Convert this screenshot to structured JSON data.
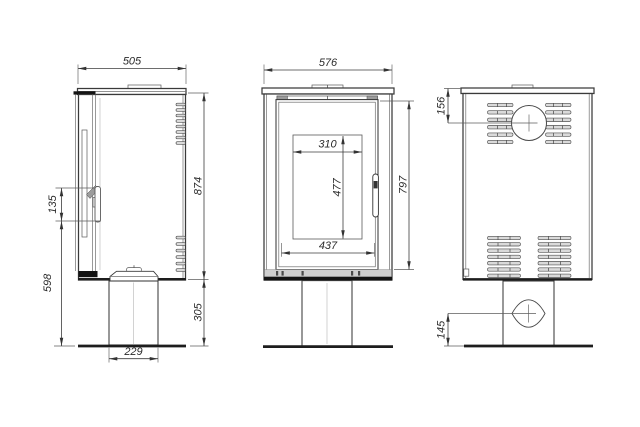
{
  "colors": {
    "background": "#ffffff",
    "outline": "#3a3a3a",
    "thick_line": "#1d1d1d",
    "dimension_line": "#3c3c3c",
    "dimension_text": "#2b2b2b",
    "vent_fill": "#dadada"
  },
  "views": {
    "side": {
      "dims": {
        "depth": "505",
        "body_height": "874",
        "pedestal_height": "305",
        "handle_bottom_to_floor": "598",
        "handle_length": "135",
        "pedestal_depth": "229"
      }
    },
    "front": {
      "dims": {
        "width": "576",
        "glass_width": "310",
        "glass_height": "477",
        "opening_width": "437",
        "front_height": "797"
      }
    },
    "back": {
      "dims": {
        "flue_center_from_top": "156",
        "inlet_center_from_floor": "145"
      }
    }
  }
}
